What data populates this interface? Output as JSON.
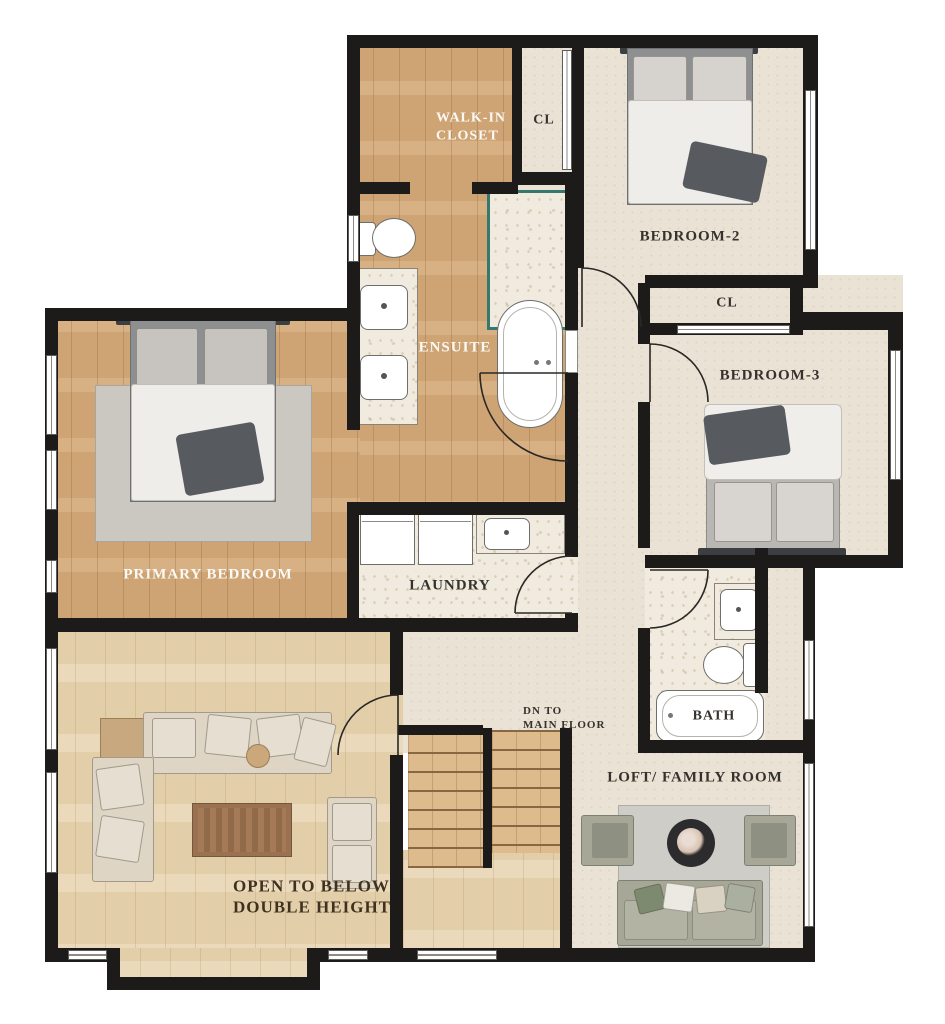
{
  "labels": {
    "walk_in_1": "WALK-IN",
    "walk_in_2": "CLOSET",
    "cl_top": "CL",
    "bedroom2": "BEDROOM-2",
    "cl_mid": "CL",
    "bedroom3": "BEDROOM-3",
    "ensuite": "ENSUITE",
    "primary_bedroom": "PRIMARY BEDROOM",
    "laundry": "LAUNDRY",
    "bath": "BATH",
    "dn_1": "DN TO",
    "dn_2": "MAIN FLOOR",
    "loft": "LOFT/ FAMILY ROOM",
    "open_1": "OPEN TO BELOW",
    "open_2": "DOUBLE HEIGHT"
  },
  "colors": {
    "wall": "#1d1b19",
    "wood_main": "#d4aa7b",
    "wood_light": "#e8d5b2",
    "carpet_beige": "#eae2d4",
    "marble": "#f1ebdf",
    "shower_glass_teal": "#35796e",
    "label_dark": "#35312c",
    "label_white": "#fbf9f4",
    "label_brown": "#40301f",
    "sofa_cream": "#ded5c4",
    "sofa_sage": "#a6a796",
    "throw_dark": "#575b60",
    "coffee_table_brown": "#9a7251"
  }
}
